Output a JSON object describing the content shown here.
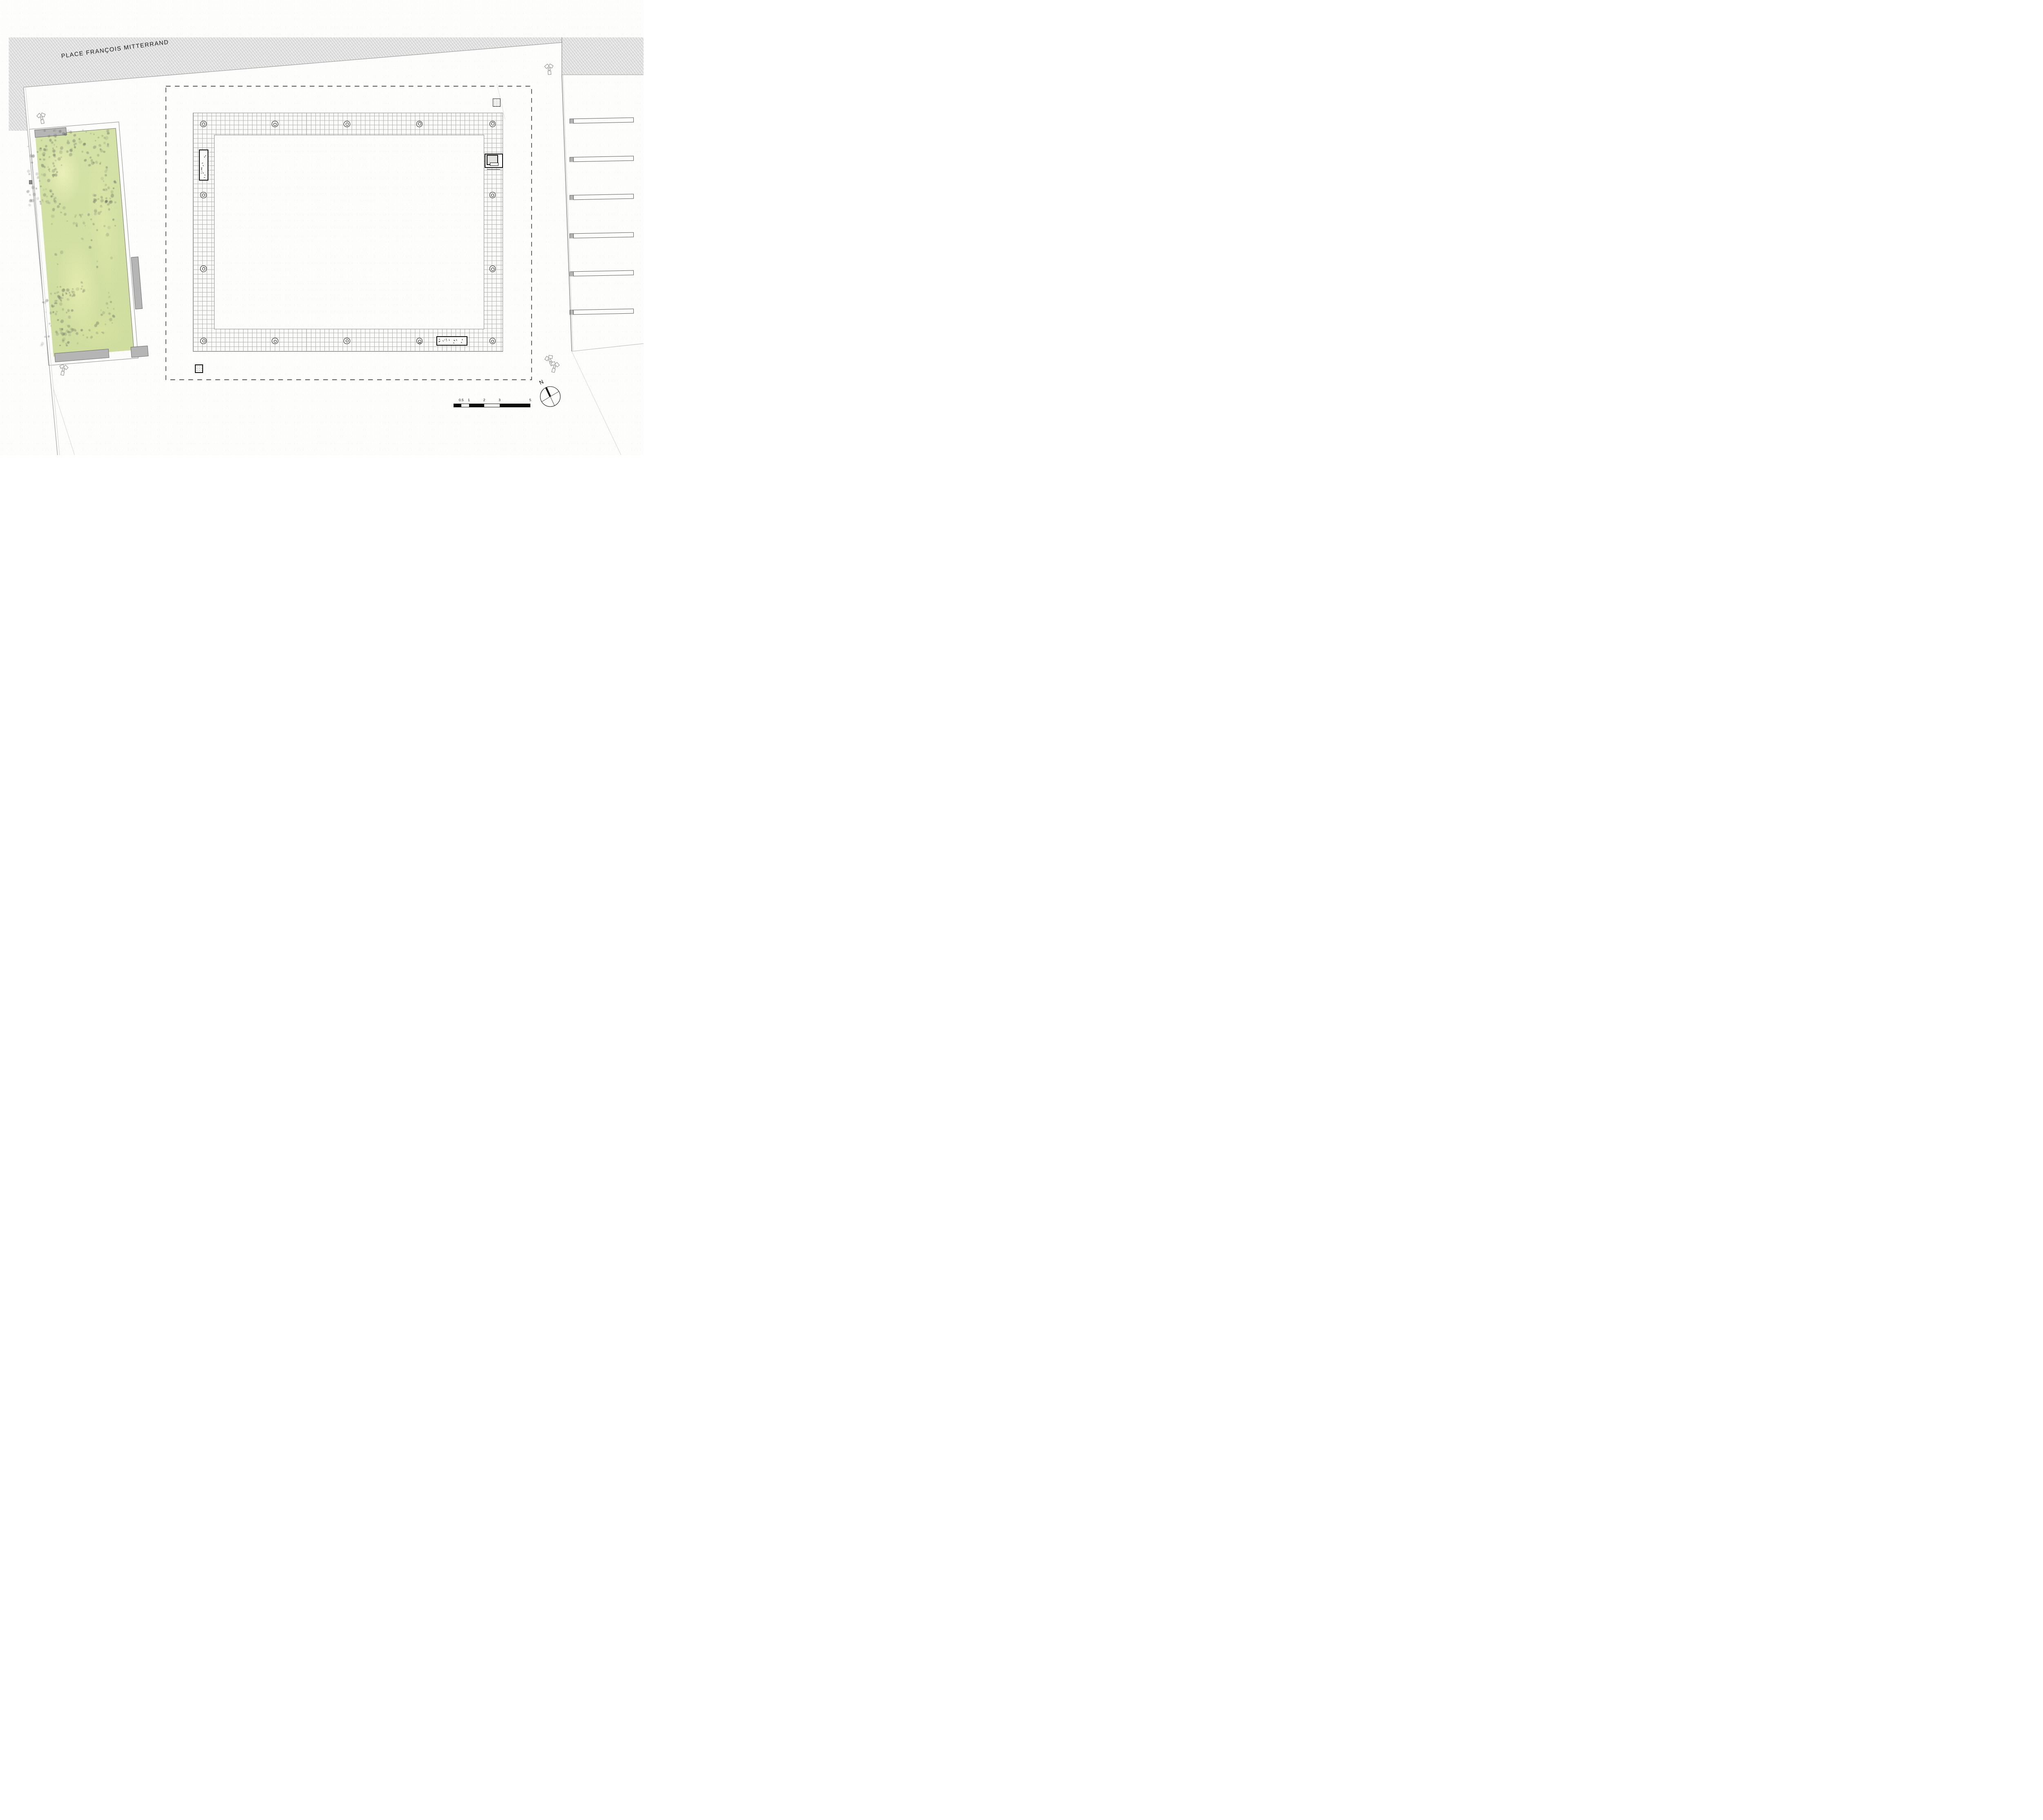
{
  "title": {
    "street_label": "PLACE FRANÇOIS MITTERRAND"
  },
  "compass": {
    "north_label": "N"
  },
  "scale_bar": {
    "labels": [
      "0.5",
      "1",
      "2",
      "3",
      "5"
    ],
    "units_shown": 5
  },
  "features": {
    "parking_stall_count": 6,
    "pergola_column_count": 14,
    "floodlight_count": 5,
    "bench_count": 2
  },
  "colors": {
    "street_hatch_gray": "#d9d9d9",
    "garden_green": "#d5e2a7",
    "grid_line_gray": "#b0b0b0",
    "boundary_dash_black": "#1f1f1f",
    "concrete_gray": "#b5b5b5"
  }
}
